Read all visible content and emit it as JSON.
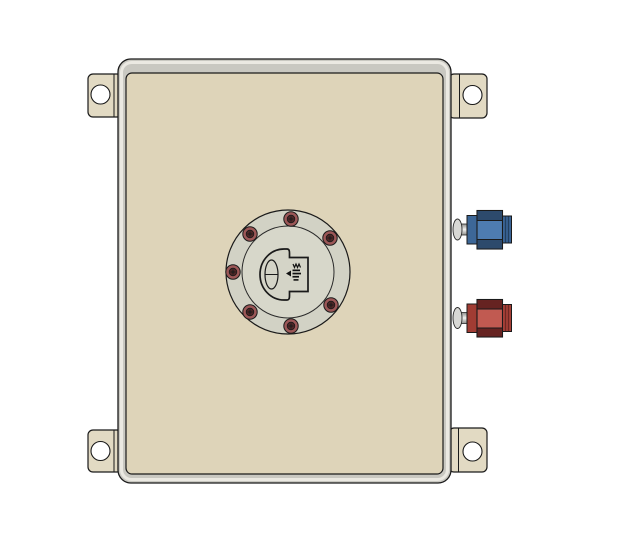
{
  "canvas": {
    "background": "#ffffff"
  },
  "colors": {
    "outline": "#1a1a1a",
    "inner_line": "#2a2a2a",
    "tank_face": "#ded4b9",
    "tank_edge": "#c9c8c1",
    "tank_edge_highlight": "#ebe9e2",
    "bracket": "#e2dac3",
    "hole": "#ffffff",
    "flange_ring": "#d2d2c5",
    "flange_inner": "#d7d7ca",
    "cap_fill": "#d4d4c7",
    "logo_ink": "#111111",
    "bolt_ring": "#9c5757",
    "bolt_center": "#4e2525",
    "bung_face": "#d8d8d5",
    "bung_body_light": "#f2f2f0",
    "bung_body_dark": "#8e8e8b"
  },
  "flange": {
    "bolt_count": 7
  },
  "fittings": {
    "blue": {
      "mid": "#4e7cb0",
      "band": "#2d4a6c",
      "collar": "#3d6797",
      "end": "#3a6496",
      "ridge": "#223f5e"
    },
    "red": {
      "mid": "#c15a51",
      "band": "#662321",
      "collar": "#a13c33",
      "end": "#a63f37",
      "ridge": "#6e2823"
    }
  }
}
